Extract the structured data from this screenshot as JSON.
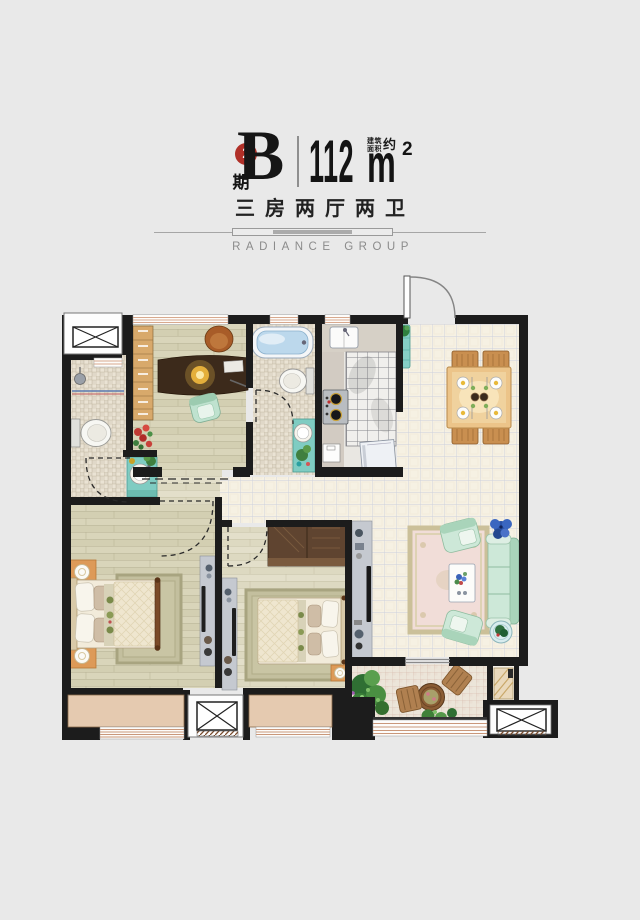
{
  "header": {
    "phase_number": "2",
    "phase_label": "期",
    "unit_letter": "B",
    "area_value": "112",
    "area_unit": "m",
    "area_exponent": "2",
    "area_note_top": "建筑",
    "area_note_bottom": "面积",
    "area_note_approx": "约",
    "subtitle": "三房两厅两卫",
    "brand": "RADIANCE GROUP"
  },
  "colors": {
    "background": "#e9e9e9",
    "accent_red": "#b03028",
    "wall_black": "#1c1c1c",
    "wood_floor": "#d3cfb2",
    "main_tile": "#f6f1e3",
    "bath_tile": "#eae3d4",
    "balcony_tile": "#ece5d9",
    "bay_window_tan": "#e5cab0",
    "sofa_green": "#cde8d8",
    "vanity_teal": "#7fccc2",
    "dining_wood": "#ecc489"
  }
}
